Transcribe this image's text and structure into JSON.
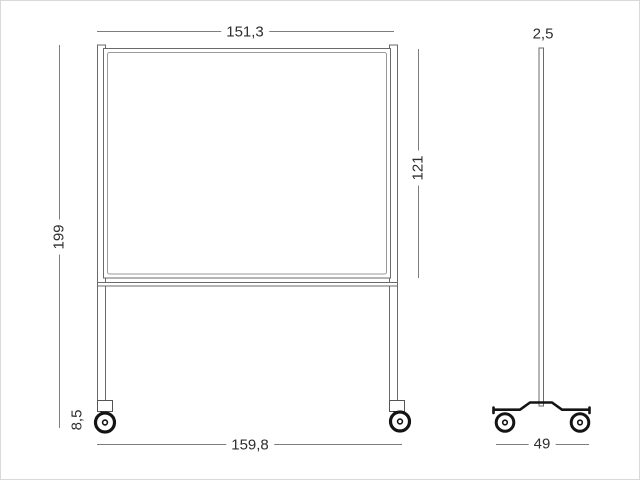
{
  "colors": {
    "structure_line": "#6a6a6a",
    "inner_frame_line": "#9a9a9a",
    "dimension_line": "#7d7d7d",
    "solid_black": "#141414",
    "text": "#2e2e2e",
    "background": "#ffffff"
  },
  "front_view": {
    "board_width": "151,3",
    "board_height": "121",
    "total_height": "199",
    "caster_height": "8,5",
    "base_width": "159,8"
  },
  "side_view": {
    "frame_thickness": "2,5",
    "base_depth": "49"
  }
}
